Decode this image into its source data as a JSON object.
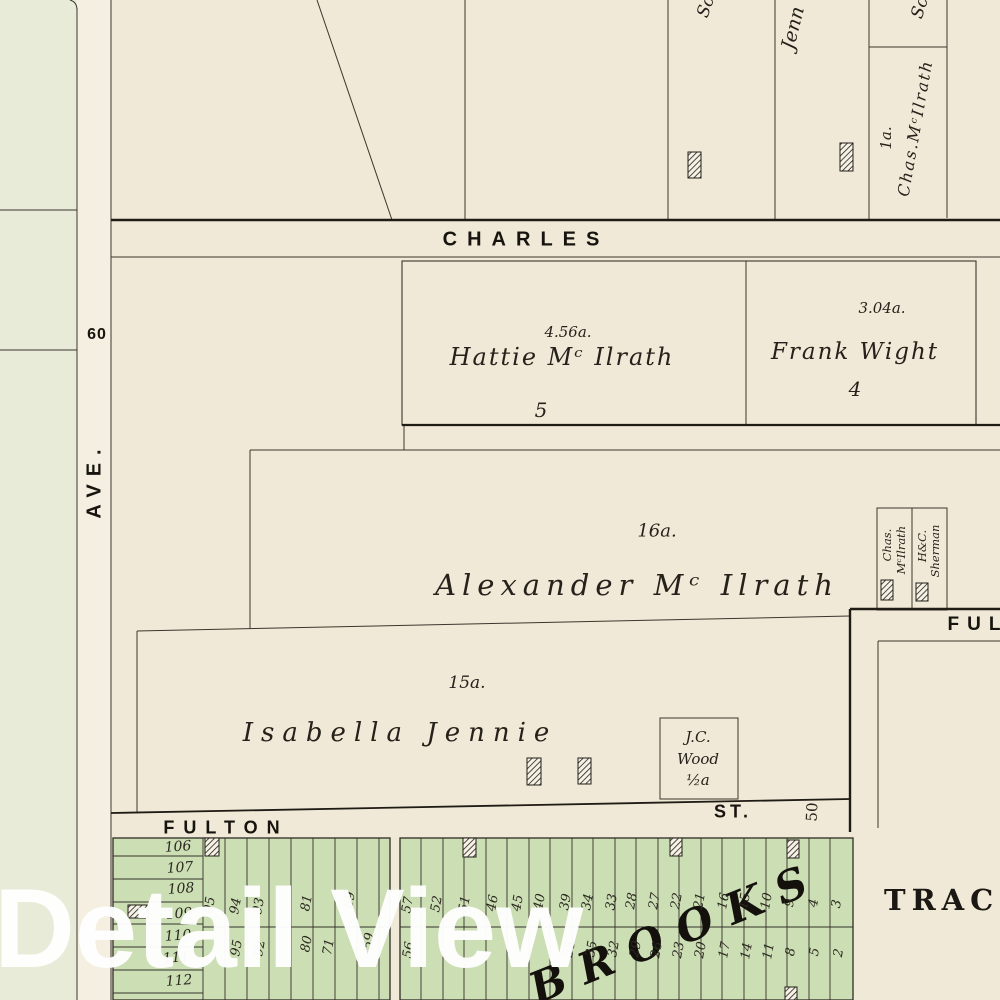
{
  "watermark": "Detail View",
  "streets": {
    "charles": "CHARLES",
    "ave": "AVE.",
    "ave_width": "60",
    "fulton": "FULTON",
    "fulton_st": "ST.",
    "fulton_width": "50",
    "fulton_upper_partial": "FUL",
    "tract_partial": "TRAC"
  },
  "parcels": {
    "hattie": {
      "area": "4.56a.",
      "name": "Hattie Mᶜ Ilrath",
      "lot": "5"
    },
    "frank": {
      "area": "3.04a.",
      "name": "Frank Wight",
      "lot": "4"
    },
    "alexander": {
      "area": "16a.",
      "name": "Alexander Mᶜ Ilrath"
    },
    "isabella": {
      "area": "15a.",
      "name": "Isabella Jennie"
    },
    "jc_wood": {
      "line1": "J.C.",
      "line2": "Wood",
      "line3": "½a"
    },
    "chas_mcilrath_top": {
      "area": "1a.",
      "name": "Chas.MᶜIlrath"
    },
    "strip_chas": {
      "line1": "Chas.",
      "line2": "MᶜIlrath"
    },
    "strip_sherman": {
      "line1": "H&C.",
      "line2": "Sherman"
    },
    "partial_sc_1": "Sc",
    "partial_jenn": "Jenn",
    "partial_sc_2": "Sc",
    "brooks": "BROOKS"
  },
  "plat": {
    "block1_rows": [
      "106",
      "107",
      "108",
      "109",
      "110",
      "111",
      "112"
    ],
    "block1_top": [
      "05",
      "94",
      "93",
      "81",
      "69"
    ],
    "block1_bottom": [
      "95",
      "92",
      "80",
      "71",
      "59"
    ],
    "block2_top": [
      "57",
      "52",
      "51",
      "46",
      "45",
      "40",
      "39",
      "34",
      "33",
      "28",
      "27",
      "22",
      "21",
      "16",
      "15",
      "10",
      "9",
      "4",
      "3"
    ],
    "block2_bottom": [
      "56",
      "38",
      "35",
      "32",
      "29",
      "26",
      "23",
      "20",
      "17",
      "14",
      "11",
      "8",
      "5",
      "2"
    ]
  },
  "colors": {
    "paper": "#f0e9d7",
    "left_block": "#e8ebd8",
    "street_band": "#f4efe1",
    "green_lots": "#cbdeb4",
    "ink": "#2e2a24",
    "watermark": "#ffffff"
  }
}
